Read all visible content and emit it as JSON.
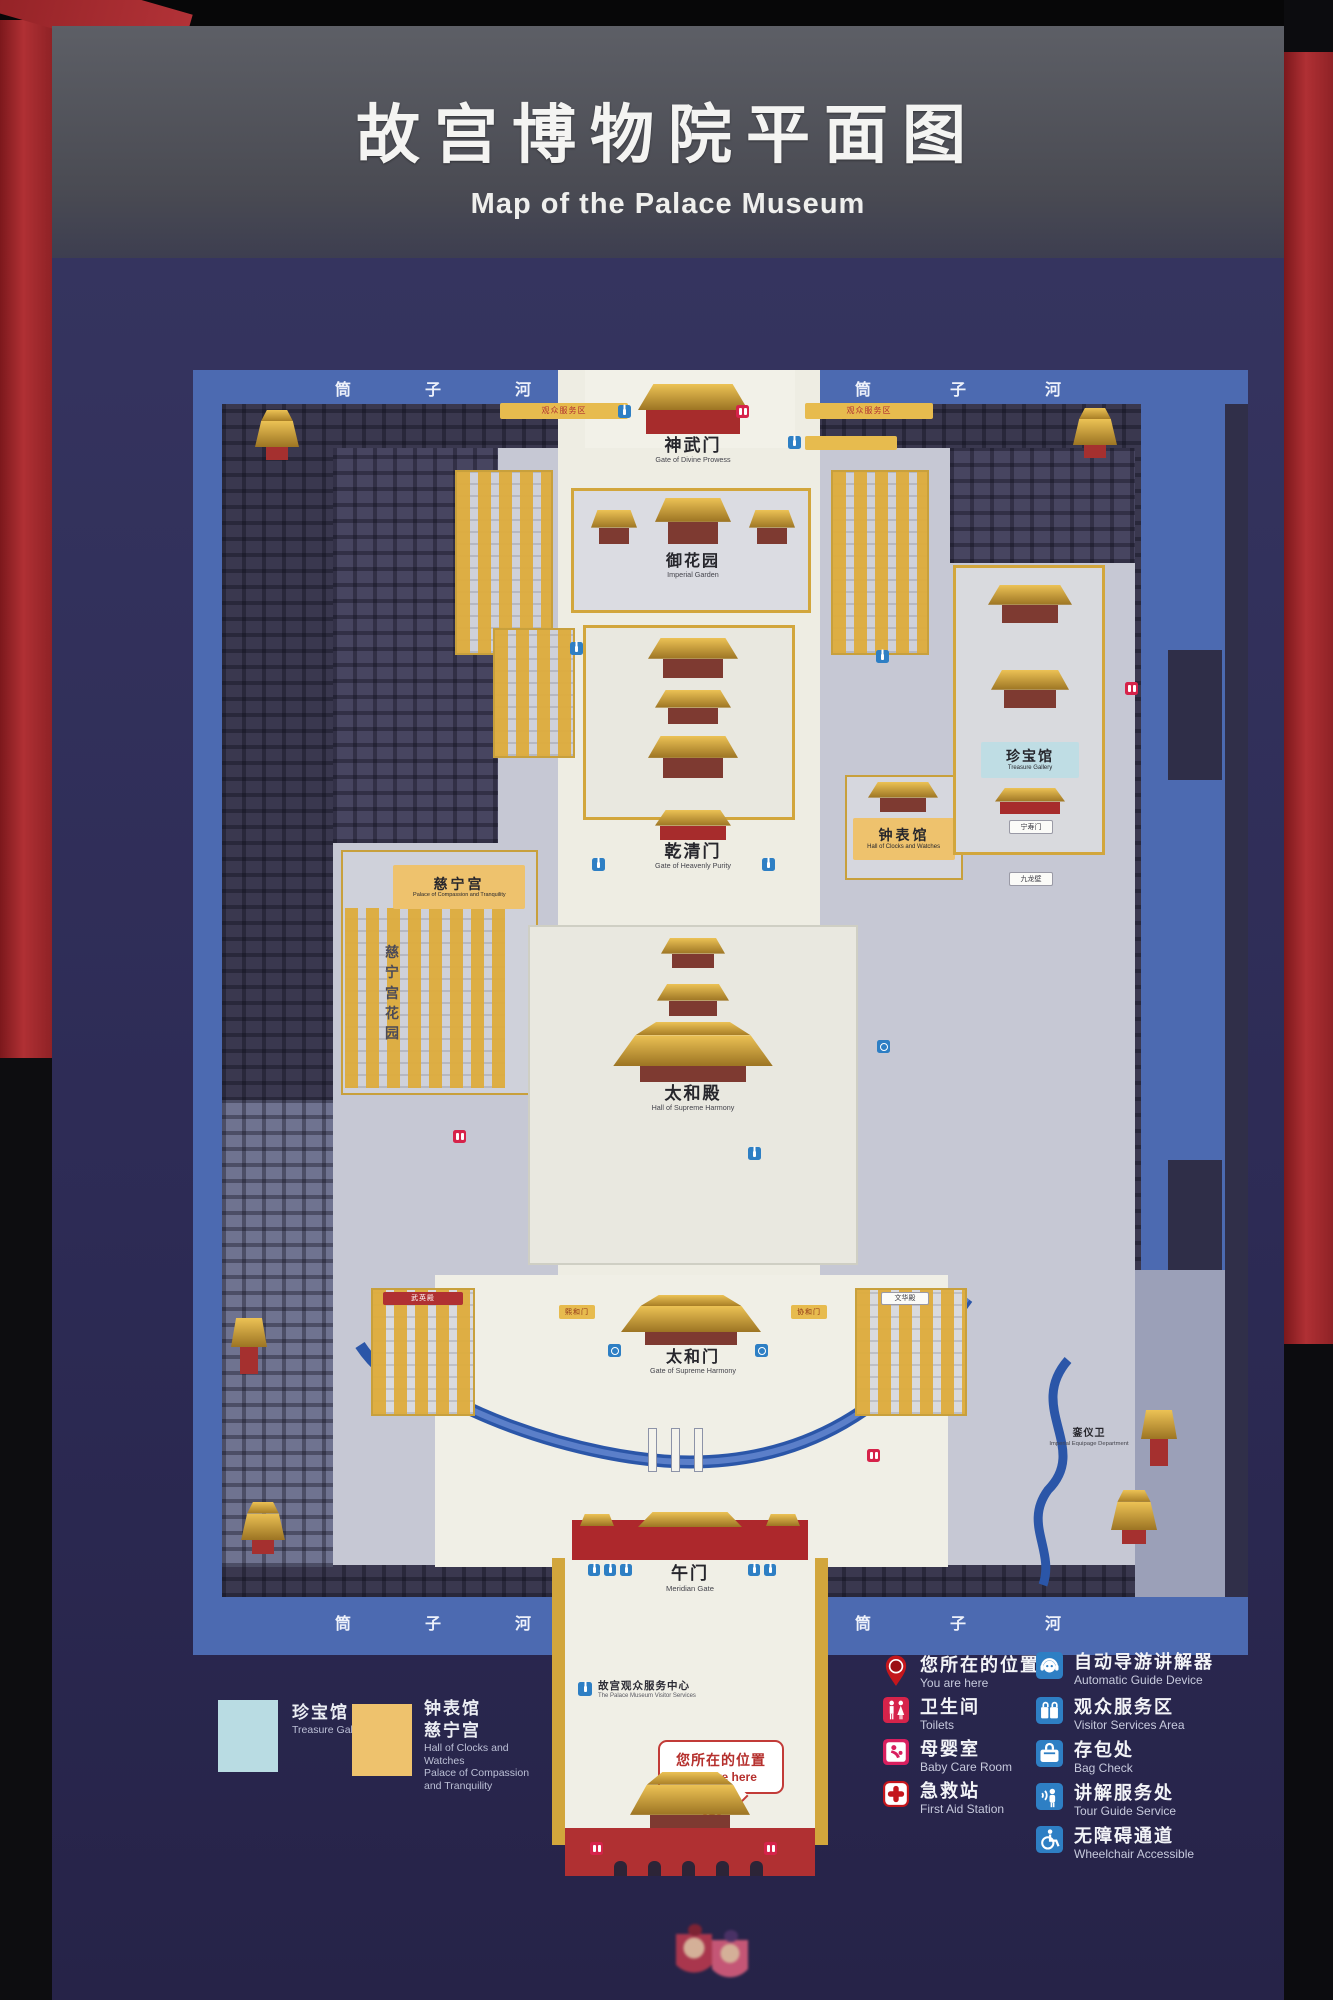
{
  "sign": {
    "title_zh": "故宫博物院平面图",
    "title_en": "Map of the Palace Museum"
  },
  "moat": {
    "c0": "筒",
    "c1": "子",
    "c2": "河"
  },
  "map_labels": {
    "shenwumen": {
      "zh": "神武门",
      "en": "Gate of Divine Prowess"
    },
    "yuhuayuan": {
      "zh": "御花园",
      "en": "Imperial Garden"
    },
    "qianqingmen": {
      "zh": "乾清门",
      "en": "Gate of Heavenly Purity"
    },
    "taihedian": {
      "zh": "太和殿",
      "en": "Hall of Supreme Harmony"
    },
    "taihemen": {
      "zh": "太和门",
      "en": "Gate of Supreme Harmony"
    },
    "wumen": {
      "zh": "午门",
      "en": "Meridian Gate"
    },
    "zhenbaoguan": {
      "zh": "珍宝馆",
      "en": "Treasure Gallery"
    },
    "zhongbiaoguan": {
      "zh": "钟表馆",
      "en": "Hall of Clocks and Watches"
    },
    "cininggong": {
      "zh": "慈宁宫",
      "en": "Palace of Compassion and Tranquility"
    },
    "cining_garden": {
      "zh": "慈宁宫花园"
    },
    "luanyiwei": {
      "zh": "銮仪卫",
      "en": "Imperial Equipage Department"
    },
    "visitor_center": {
      "zh": "故宫观众服务中心",
      "en": "The Palace Museum Visitor Services"
    },
    "you_are_here": {
      "zh": "您所在的位置",
      "en": "You are here"
    },
    "fuwuqu": {
      "zh": "观众服务区"
    },
    "xihemen": {
      "zh": "熙和门"
    },
    "xiehemen": {
      "zh": "协和门"
    },
    "ningshoumen": {
      "zh": "宁寿门"
    },
    "jiulongbi": {
      "zh": "九龙壁"
    },
    "wuyingdian": {
      "zh": "武英殿"
    },
    "wenhuadian": {
      "zh": "文华殿"
    }
  },
  "legend_swatches": {
    "treasure": {
      "color": "#b9dce3",
      "zh": "珍宝馆",
      "en": "Treasure Gallery"
    },
    "clocks": {
      "color": "#eec26d",
      "zh_1": "钟表馆",
      "zh_2": "慈宁宫",
      "en_1": "Hall of Clocks and Watches",
      "en_2": "Palace of Compassion and Tranquility"
    }
  },
  "legend_services": [
    {
      "icon": "you-are-here-pin",
      "zh": "您所在的位置",
      "en": "You are here"
    },
    {
      "icon": "toilets",
      "zh": "卫生间",
      "en": "Toilets"
    },
    {
      "icon": "baby-care",
      "zh": "母婴室",
      "en": "Baby Care Room"
    },
    {
      "icon": "first-aid",
      "zh": "急救站",
      "en": "First Aid Station"
    }
  ],
  "legend_facilities": [
    {
      "icon": "audio-guide",
      "zh": "自动导游讲解器",
      "en": "Automatic Guide Device"
    },
    {
      "icon": "visitor-services",
      "zh": "观众服务区",
      "en": "Visitor Services Area"
    },
    {
      "icon": "bag-check",
      "zh": "存包处",
      "en": "Bag Check"
    },
    {
      "icon": "tour-guide",
      "zh": "讲解服务处",
      "en": "Tour Guide Service"
    },
    {
      "icon": "wheelchair",
      "zh": "无障碍通道",
      "en": "Wheelchair Accessible"
    }
  ],
  "colors": {
    "panel_navy": "#2f2e59",
    "moat_blue": "#4c6ab1",
    "axis_cream": "#eeede3",
    "wall_yellow": "#d2a63c",
    "highlight_blue": "#bfdde4",
    "highlight_orange": "#eec26d",
    "gate_red": "#ad282c",
    "service_blue": "#2e7fc4",
    "service_red": "#d6234a"
  }
}
